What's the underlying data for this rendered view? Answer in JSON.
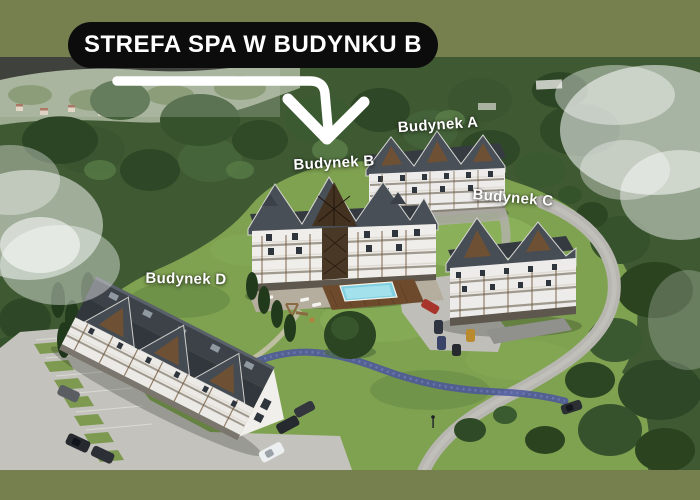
{
  "frame": {
    "background_color": "#76804f"
  },
  "badge": {
    "text": "STREFA SPA W BUDYNKU B",
    "background_color": "#0c0c0c",
    "text_color": "#ffffff"
  },
  "annotation_arrow": {
    "icon": "bent-down-arrow",
    "color": "#ffffff"
  },
  "building_labels": [
    {
      "id": "a",
      "text": "Budynek A"
    },
    {
      "id": "b",
      "text": "Budynek B"
    },
    {
      "id": "c",
      "text": "Budynek C"
    },
    {
      "id": "d",
      "text": "Budynek D"
    }
  ],
  "scene": {
    "type": "aerial-render-of-apartment-complex",
    "palette": {
      "grass": "#7fa251",
      "forest": "#3f5a33",
      "roof": "#42484f",
      "facade": "#edecea",
      "wood_accent": "#6e5134",
      "pool_water": "#7fd0e0",
      "road": "#b7b6b0",
      "fog": "#ffffff",
      "stream": "#4a569c"
    }
  }
}
